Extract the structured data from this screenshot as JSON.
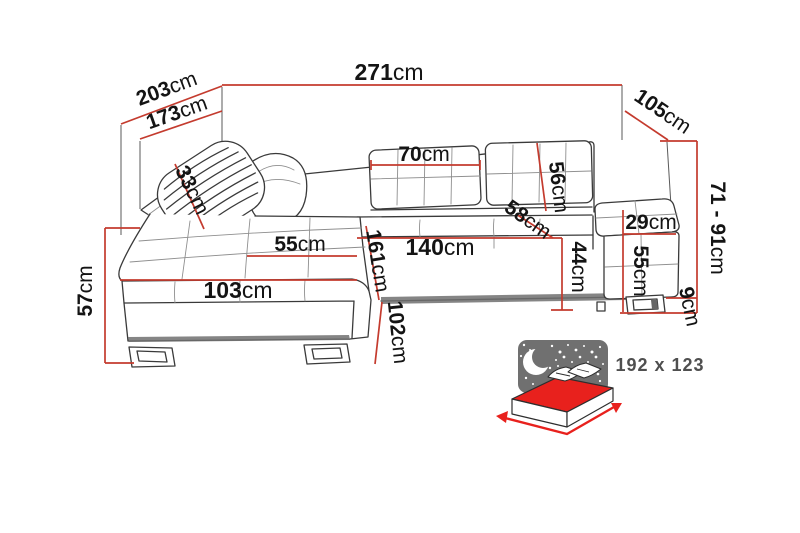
{
  "diagram_title": "corner-sofa-dimension-diagram",
  "dimensions": {
    "total_width": {
      "value": "271",
      "unit": "cm"
    },
    "corner_depth_outer": {
      "value": "203",
      "unit": "cm"
    },
    "corner_depth_inner": {
      "value": "173",
      "unit": "cm"
    },
    "side_depth": {
      "value": "105",
      "unit": "cm"
    },
    "headrest_cushion_width": {
      "value": "33",
      "unit": "cm"
    },
    "back_cushion_width": {
      "value": "70",
      "unit": "cm"
    },
    "backrest_height": {
      "value": "56",
      "unit": "cm"
    },
    "back_height_from_seat": {
      "value": "58",
      "unit": "cm"
    },
    "armrest_width": {
      "value": "29",
      "unit": "cm"
    },
    "adjustable_back_height": {
      "value": "71 - 91",
      "unit": "cm"
    },
    "seat_depth": {
      "value": "55",
      "unit": "cm"
    },
    "seat_width": {
      "value": "140",
      "unit": "cm"
    },
    "seat_front_height": {
      "value": "44",
      "unit": "cm"
    },
    "armrest_height": {
      "value": "55",
      "unit": "cm"
    },
    "chaise_length": {
      "value": "161",
      "unit": "cm"
    },
    "chaise_front_width": {
      "value": "103",
      "unit": "cm"
    },
    "chaise_side_height": {
      "value": "57",
      "unit": "cm"
    },
    "chaise_base_depth": {
      "value": "102",
      "unit": "cm"
    },
    "leg_height": {
      "value": "9",
      "unit": "cm"
    }
  },
  "sleeping_function": {
    "label": "192 x 123"
  },
  "colors": {
    "dimension_line": "#c43b2e",
    "outline": "#3a3a3a",
    "bed_red": "#e8211d",
    "night_sky_gray": "#707070",
    "label_text": "#141414",
    "sleeping_text": "#4f4f4f",
    "background": "#ffffff"
  }
}
